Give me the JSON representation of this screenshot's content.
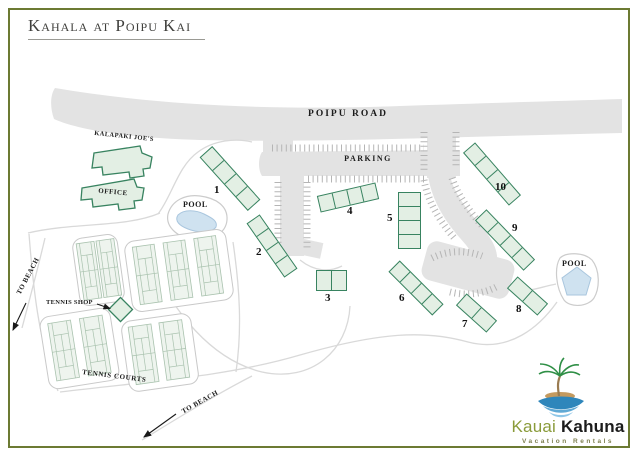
{
  "title": "Kahala at Poipu Kai",
  "map": {
    "road_label": "POIPU ROAD",
    "parking_label": "PARKING",
    "kalapaki_label": "KALAPAKI JOE'S",
    "office_label": "OFFICE",
    "pool_label": "POOL",
    "tennis_shop_label": "TENNIS SHOP",
    "tennis_courts_label": "TENNIS COURTS",
    "to_beach_label": "TO BEACH",
    "buildings": [
      {
        "label": "1"
      },
      {
        "label": "2"
      },
      {
        "label": "3"
      },
      {
        "label": "4"
      },
      {
        "label": "5"
      },
      {
        "label": "6"
      },
      {
        "label": "7"
      },
      {
        "label": "8"
      },
      {
        "label": "9"
      },
      {
        "label": "10"
      }
    ]
  },
  "logo": {
    "brand_first": "Kauai",
    "brand_second": "Kahuna",
    "tagline": "Vacation Rentals"
  },
  "colors": {
    "frame_olive": "#6c7a33",
    "building_outline_green": "#388360",
    "building_fill_green": "#e3efe4",
    "road_gray": "#e3e3e3",
    "pool_blue": "#cfe2f0",
    "logo_green": "#8a9b3a",
    "logo_black": "#1c1c1c"
  }
}
